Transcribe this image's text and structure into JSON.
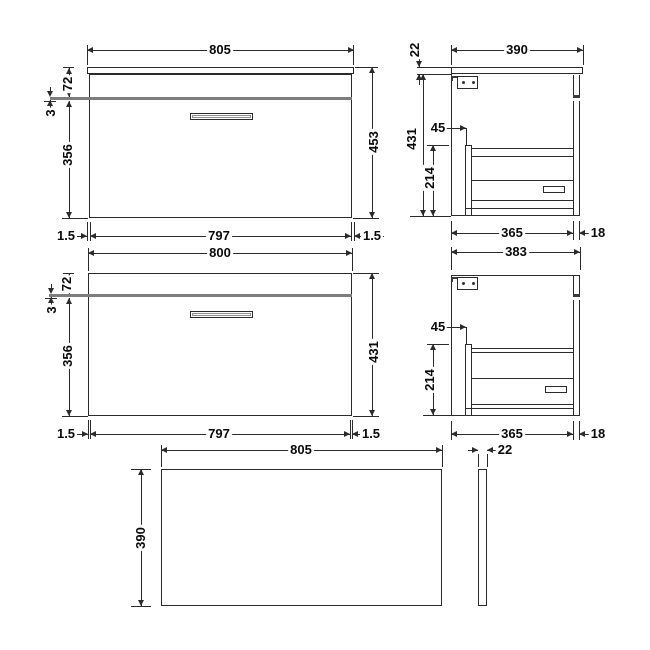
{
  "sheet": {
    "kind": "technical dimension drawing",
    "subject": "wall-hung drawer vanity unit with worktop",
    "units": "mm"
  },
  "colors": {
    "background": "#ffffff",
    "line": "#2b2b2b",
    "gap_band": "#7d7d7d",
    "text": "#0a0a0a"
  },
  "views": {
    "front_worktop": {
      "title": "front view with worktop",
      "dims": {
        "width": "805",
        "top_height": "72",
        "gap": "3",
        "drawer_height": "356",
        "height": "453",
        "left_edge": "1.5",
        "drawer_width": "797",
        "right_edge": "1.5"
      }
    },
    "side_worktop": {
      "title": "side view with worktop",
      "dims": {
        "thickness": "22",
        "depth": "390",
        "height": "431",
        "setback": "45",
        "box_height": "214",
        "body_depth": "365",
        "back": "18"
      }
    },
    "front_carcass": {
      "title": "front view of carcass",
      "dims": {
        "width": "800",
        "top_height": "72",
        "gap": "3",
        "drawer_height": "356",
        "height": "431",
        "left_edge": "1.5",
        "drawer_width": "797",
        "right_edge": "1.5"
      }
    },
    "side_carcass": {
      "title": "side view of carcass",
      "dims": {
        "depth": "383",
        "setback": "45",
        "box_height": "214",
        "body_depth": "365",
        "back": "18"
      }
    },
    "plan_worktop": {
      "title": "worktop plan view",
      "dims": {
        "width": "805",
        "depth": "390",
        "thickness": "22"
      }
    }
  }
}
